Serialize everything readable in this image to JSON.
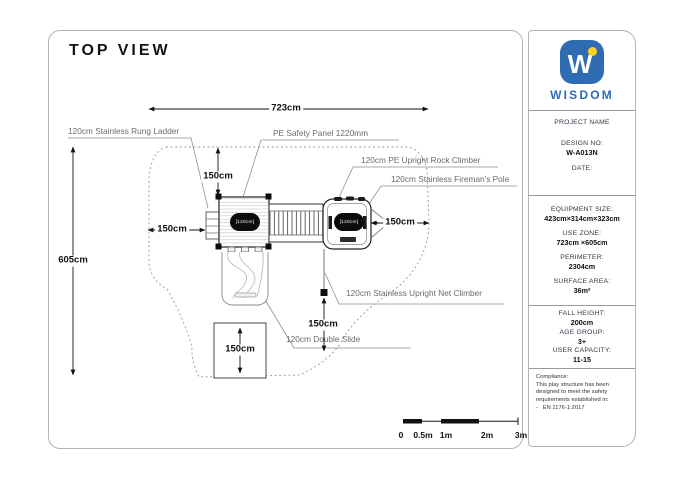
{
  "drawing": {
    "title": "TOP VIEW",
    "dims": {
      "use_zone_width": "723cm",
      "use_zone_height": "605cm",
      "clearance_top": "150cm",
      "clearance_left": "150cm",
      "clearance_right": "150cm",
      "net_clearance": "150cm",
      "slide_exit": "150cm"
    },
    "platform_badge": "[120cm]",
    "leaders": {
      "rung_ladder": "120cm Stainless Rung Ladder",
      "safety_panel": "PE Safety Panel 1220mm",
      "rock_climber": "120cm PE Upright Rock Climber",
      "fireman_pole": "120cm Stainless Fireman's Pole",
      "net_climber": "120cm Stainless Upright Net Climber",
      "double_slide": "120cm Double Slide"
    },
    "scalebar": [
      "0",
      "0.5m",
      "1m",
      "2m",
      "3m"
    ]
  },
  "sidebar": {
    "logo_letter": "W",
    "brand": "WISDOM",
    "project_name_label": "PROJECT NAME",
    "design": {
      "label": "DESIGN NO:",
      "value": "W-A013N"
    },
    "date_label": "DATE:",
    "specs": [
      {
        "label": "EQUIPMENT SIZE:",
        "value": "423cm×314cm×323cm"
      },
      {
        "label": "USE ZONE:",
        "value": "723cm ×605cm"
      },
      {
        "label": "PERIMETER:",
        "value": "2304cm"
      },
      {
        "label": "SURFACE AREA:",
        "value": "36m²"
      }
    ],
    "safety": [
      {
        "label": "FALL HEIGHT:",
        "value": "200cm"
      },
      {
        "label": "AGE GROUP:",
        "value": "3+"
      },
      {
        "label": "USER CAPACITY:",
        "value": "11-15"
      }
    ],
    "compliance": {
      "label": "Compliance:",
      "text": "This play structure has been designed to meet the safety requirements established in:",
      "standard": "-   EN 1176-1:2017"
    }
  },
  "colors": {
    "brand_blue": "#2f6cb3",
    "brand_yellow": "#ffd21e"
  }
}
